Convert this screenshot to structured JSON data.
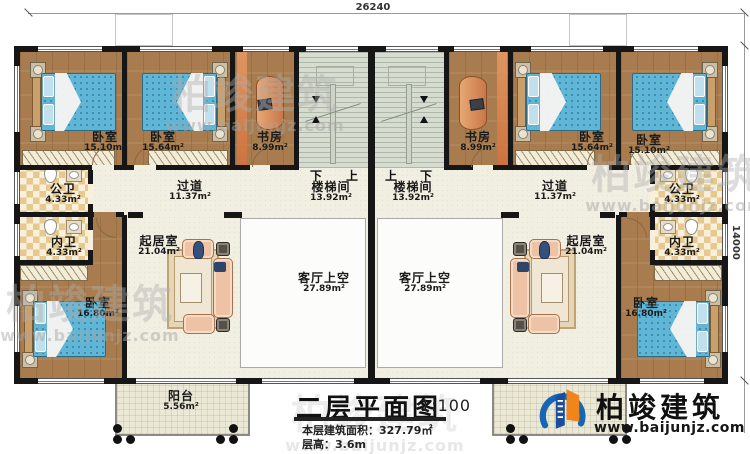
{
  "dimensions": {
    "top": "26240",
    "right": "14000"
  },
  "rooms": {
    "bedroom_l1": {
      "name": "卧室",
      "area": "15.10m²"
    },
    "bedroom_l2": {
      "name": "卧室",
      "area": "15.64m²"
    },
    "study_l": {
      "name": "书房",
      "area": "8.99m²"
    },
    "stair_l": {
      "name": "楼梯间",
      "area": "13.92m²"
    },
    "corridor_l": {
      "name": "过道",
      "area": "11.37m²"
    },
    "public_bath_l": {
      "name": "公卫",
      "area": "4.33m²"
    },
    "private_bath_l": {
      "name": "内卫",
      "area": "4.33m²"
    },
    "bedroom_bl": {
      "name": "卧室",
      "area": "16.80m²"
    },
    "living_l": {
      "name": "起居室",
      "area": "21.04m²"
    },
    "void_l": {
      "name": "客厅上空",
      "area": "27.89m²"
    },
    "balcony": {
      "name": "阳台",
      "area": "5.56m²"
    },
    "stair_r": {
      "name": "楼梯间",
      "area": "13.92m²"
    },
    "study_r": {
      "name": "书房",
      "area": "8.99m²"
    },
    "bedroom_r1": {
      "name": "卧室",
      "area": "15.64m²"
    },
    "bedroom_r2": {
      "name": "卧室",
      "area": "15.10m²"
    },
    "corridor_r": {
      "name": "过道",
      "area": "11.37m²"
    },
    "public_bath_r": {
      "name": "公卫",
      "area": "4.33m²"
    },
    "private_bath_r": {
      "name": "内卫",
      "area": "4.33m²"
    },
    "bedroom_br": {
      "name": "卧室",
      "area": "16.80m²"
    },
    "living_r": {
      "name": "起居室",
      "area": "21.04m²"
    },
    "void_r": {
      "name": "客厅上空",
      "area": "27.89m²"
    }
  },
  "stair_marks": {
    "left_down": "下",
    "left_up": "上",
    "right_up": "上",
    "right_down": "下"
  },
  "title_block": {
    "title": "二层平面图",
    "scale": "1:100",
    "area_line": "本层建筑面积：327.79㎡",
    "height_line": "层高：3.6m"
  },
  "logo": {
    "name": "柏竣建筑",
    "website": "www.baijunjz.com"
  },
  "watermark": {
    "name": "柏竣建筑",
    "website": "www.baijunjz.com"
  },
  "colors": {
    "wall": "#161616",
    "wood": "#a87c4e",
    "logo_blue": "#1766b3",
    "logo_orange": "#f08519"
  }
}
